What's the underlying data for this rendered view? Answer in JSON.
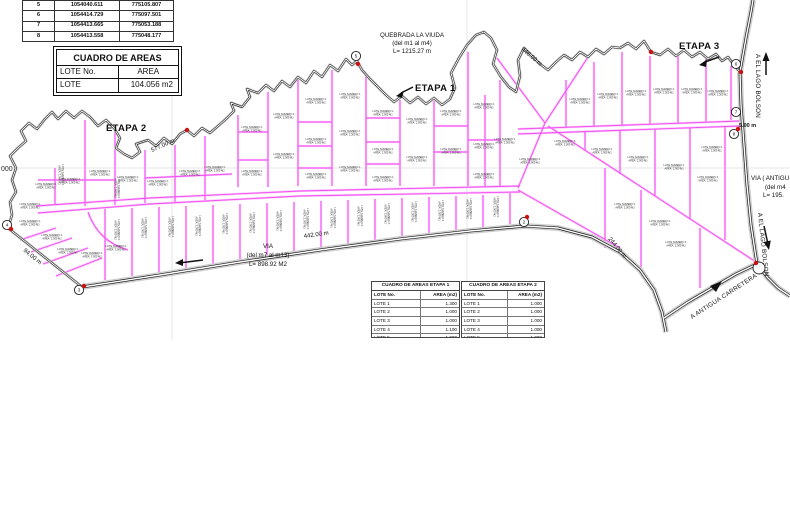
{
  "drawing": {
    "etapa1": "ETAPA 1",
    "etapa2": "ETAPA 2",
    "etapa3": "ETAPA 3",
    "quebrada": {
      "line1": "QUEBRADA LA VIUDA",
      "line2": "(del m1 al m4)",
      "line3": "L= 1215.27 m"
    },
    "via": {
      "line1": "VIA",
      "line2": "(del m7 al m13)",
      "line3": "L= 898.92 M2"
    },
    "via_antigua": {
      "line1": "VIA ( ANTIGU",
      "line2": "(del m4",
      "line3": "L= 195."
    },
    "dims": {
      "d442": "442.00 m",
      "d577": "577.00 m",
      "d94": "94.00 m",
      "d448": "448.00 m",
      "d244": "244.00 m",
      "d5": "5.00 m"
    },
    "roads": {
      "lago_up": "A EL LAGO BOLSON",
      "lago_down": "A EL LAGO BOLSON",
      "antigua": "A ANTIGUA CARRETERA"
    },
    "grid_label": "000",
    "markers": [
      "2",
      "3",
      "4",
      "5",
      "6",
      "7",
      "8"
    ],
    "lot_label": {
      "line1": "LOTE NUMERO 1",
      "line2": "AREA: 1,000 M2"
    }
  },
  "coord_table": {
    "rows": [
      [
        "5",
        "1054040.611",
        "775105.807"
      ],
      [
        "6",
        "1054414.729",
        "775097.501"
      ],
      [
        "7",
        "1054413.665",
        "775053.188"
      ],
      [
        "8",
        "1054413.558",
        "775048.177"
      ]
    ]
  },
  "area_table": {
    "title": "CUADRO DE AREAS",
    "col1": "LOTE No.",
    "col2": "AREA",
    "row": [
      "LOTE",
      "104.056 m2"
    ]
  },
  "etapa_tables": [
    {
      "title": "CUADRO DE AREAS ETAPA 1",
      "col1": "LOTE No.",
      "col2": "AREA (m2)",
      "rows": [
        [
          "LOTE 1",
          "1.300"
        ],
        [
          "LOTE 2",
          "1.000"
        ],
        [
          "LOTE 3",
          "1.000"
        ],
        [
          "LOTE 4",
          "1.100"
        ],
        [
          "LOTE 5",
          "1.000"
        ],
        [
          "LOTE 6",
          "1.000"
        ]
      ]
    },
    {
      "title": "CUADRO DE AREAS ETAPA 2",
      "col1": "LOTE No.",
      "col2": "AREA (m2)",
      "rows": [
        [
          "LOTE 1",
          "1.000"
        ],
        [
          "LOTE 2",
          "1.000"
        ],
        [
          "LOTE 3",
          "1.000"
        ],
        [
          "LOTE 4",
          "1.000"
        ],
        [
          "LOTE 5",
          "1.000"
        ],
        [
          "LOTE 6",
          "1.000"
        ]
      ]
    }
  ],
  "colors": {
    "lot_line": "#f04df0",
    "lot_line_light": "#ffc2ff",
    "boundary": "#1a1a1a",
    "marker_red": "#cc1111",
    "grid": "#e4e4e4"
  }
}
